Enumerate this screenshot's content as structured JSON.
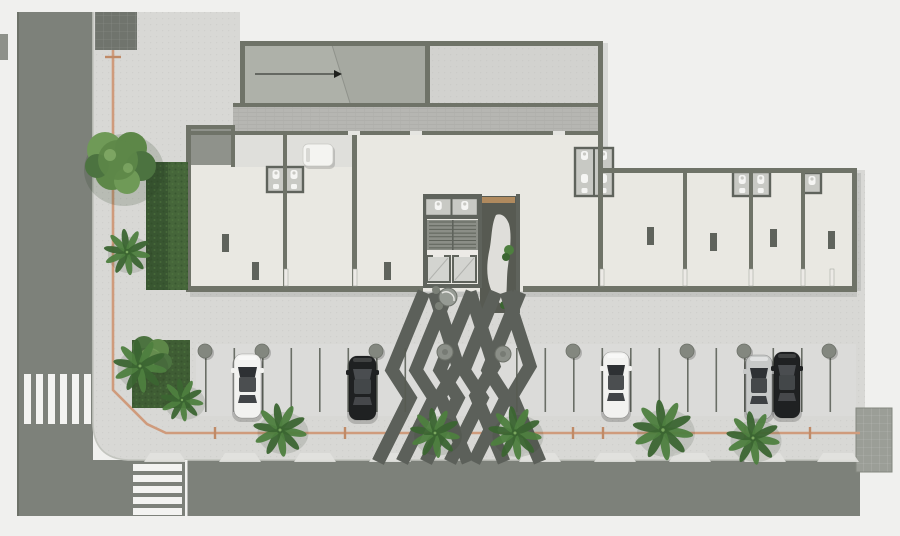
{
  "colors": {
    "background": "#f0f0ee",
    "road": "#7d817a",
    "road_edge": "#6d7168",
    "median": "#8e918a",
    "sidewalk": "#d8d8d5",
    "parking_surface": "#dcdcd9",
    "curb": "#c3c5bf",
    "crosswalk": "#f3f3f1",
    "wall": "#6f7368",
    "wall_dark": "#5f635c",
    "floor": "#e9e8e2",
    "corridor": "#b6b6b2",
    "vestibule": "#dfdfdb",
    "court": "#d2d2cf",
    "ramp": "#a6a9a1",
    "ramp_slope": "#aeb1a9",
    "gray_room": "#8f928b",
    "wc_floor": "#c8c9c4",
    "fixture": "#f5f5f3",
    "core_dark": "#575a52",
    "stair_floor": "#8b8e87",
    "tread": "#5e625a",
    "elevator": "#d3d4d0",
    "mat": "#b08a5e",
    "stripe": "#5c605a",
    "planter": "#8b8f88",
    "hedge": "#3f5d34",
    "hedge_dark": "#395631",
    "hedge_light": "#46663a",
    "tree1": "#5d8748",
    "tree2": "#6f9a57",
    "tree3": "#4c7340",
    "palm1": "#4e7f3f",
    "palm2": "#3b6531",
    "guideline": "#cf9b7c",
    "guideline_tick": "#c08a66",
    "pad": "#9b9e97",
    "block": "#70746d",
    "apron": "#e2e2df",
    "stall_line": "#565a51",
    "bollard": "#83877f",
    "car_white": "#f2f2f0",
    "car_black": "#1f2122",
    "car_silver": "#c7c9c8",
    "glass": "#2e3134",
    "glass_light": "#4a4d50",
    "door": "#eceae6",
    "white_van": "#f4f4f1"
  },
  "crosswalks": {
    "left": {
      "x": 24,
      "y": 374,
      "stripe_w": 7,
      "stripe_h": 50,
      "gap": 5,
      "count": 6
    },
    "bottom": {
      "x": 133,
      "y": 464,
      "stripe_w": 49,
      "stripe_h": 7,
      "gap": 4,
      "count": 5
    },
    "stop_line": {
      "x": 185,
      "y": 460,
      "w": 2.5,
      "h": 56
    }
  },
  "guideline": {
    "points": "113,12 113,390 147,424 166,433 860,433",
    "vertical_ticks_y": [
      57
    ],
    "horizontal_ticks_x": [
      215,
      345,
      573,
      603,
      745,
      810
    ]
  },
  "parking": {
    "rows": [
      {
        "start": 205,
        "step": 28.5,
        "count": 8,
        "y1": 348,
        "y2": 412
      },
      {
        "start": 516,
        "step": 28.5,
        "count": 12,
        "y1": 348,
        "y2": 412
      }
    ],
    "bollards_x": [
      205,
      262,
      376,
      573,
      687,
      744,
      829
    ],
    "bollard_y": 351,
    "bollard_r": 7,
    "cars": [
      {
        "x": 234,
        "y": 354,
        "w": 27,
        "h": 64,
        "body": "car_white",
        "glass": "glass"
      },
      {
        "x": 349,
        "y": 356,
        "w": 27,
        "h": 64,
        "body": "car_black",
        "glass": "glass_light"
      },
      {
        "x": 603,
        "y": 352,
        "w": 26,
        "h": 66,
        "body": "car_white",
        "glass": "glass"
      },
      {
        "x": 746,
        "y": 355,
        "w": 26,
        "h": 64,
        "body": "car_silver",
        "glass": "glass"
      },
      {
        "x": 774,
        "y": 352,
        "w": 26,
        "h": 66,
        "body": "car_black",
        "glass": "glass_light"
      }
    ]
  },
  "walkway": {
    "bands_left_x": [
      424,
      448,
      472,
      496,
      520
    ],
    "bands_right_x": [
      434,
      470,
      506
    ],
    "band_width": 13,
    "planters": [
      {
        "x": 445,
        "y": 352
      },
      {
        "x": 503,
        "y": 354
      }
    ],
    "planter_r": 8
  },
  "palms": [
    {
      "x": 127,
      "y": 252,
      "s": 26
    },
    {
      "x": 140,
      "y": 366,
      "s": 30
    },
    {
      "x": 182,
      "y": 400,
      "s": 24
    },
    {
      "x": 280,
      "y": 430,
      "s": 30
    },
    {
      "x": 435,
      "y": 433,
      "s": 28
    },
    {
      "x": 515,
      "y": 433,
      "s": 30
    },
    {
      "x": 663,
      "y": 430,
      "s": 34
    },
    {
      "x": 753,
      "y": 438,
      "s": 30
    }
  ],
  "aprons_x": [
    165,
    240,
    315,
    390,
    540,
    615,
    690,
    765,
    838
  ],
  "wc_clusters": [
    {
      "x": 267,
      "y": 167,
      "w": 36,
      "h": 25,
      "cols": 2
    },
    {
      "x": 425,
      "y": 198,
      "w": 53,
      "h": 18,
      "cols": 2
    },
    {
      "x": 575,
      "y": 148,
      "w": 38,
      "h": 48,
      "cols": 2
    },
    {
      "x": 733,
      "y": 172,
      "w": 37,
      "h": 24,
      "cols": 2
    },
    {
      "x": 803,
      "y": 173,
      "w": 18,
      "h": 20,
      "cols": 1
    }
  ],
  "columns": [
    {
      "x": 222,
      "y": 234
    },
    {
      "x": 252,
      "y": 262
    },
    {
      "x": 384,
      "y": 262
    },
    {
      "x": 647,
      "y": 227
    },
    {
      "x": 710,
      "y": 233
    },
    {
      "x": 770,
      "y": 229
    },
    {
      "x": 828,
      "y": 231
    }
  ],
  "door_slabs_x": [
    284,
    353,
    600,
    683,
    749,
    801,
    830
  ],
  "corridor_gaps_x": [
    348,
    410,
    553
  ]
}
